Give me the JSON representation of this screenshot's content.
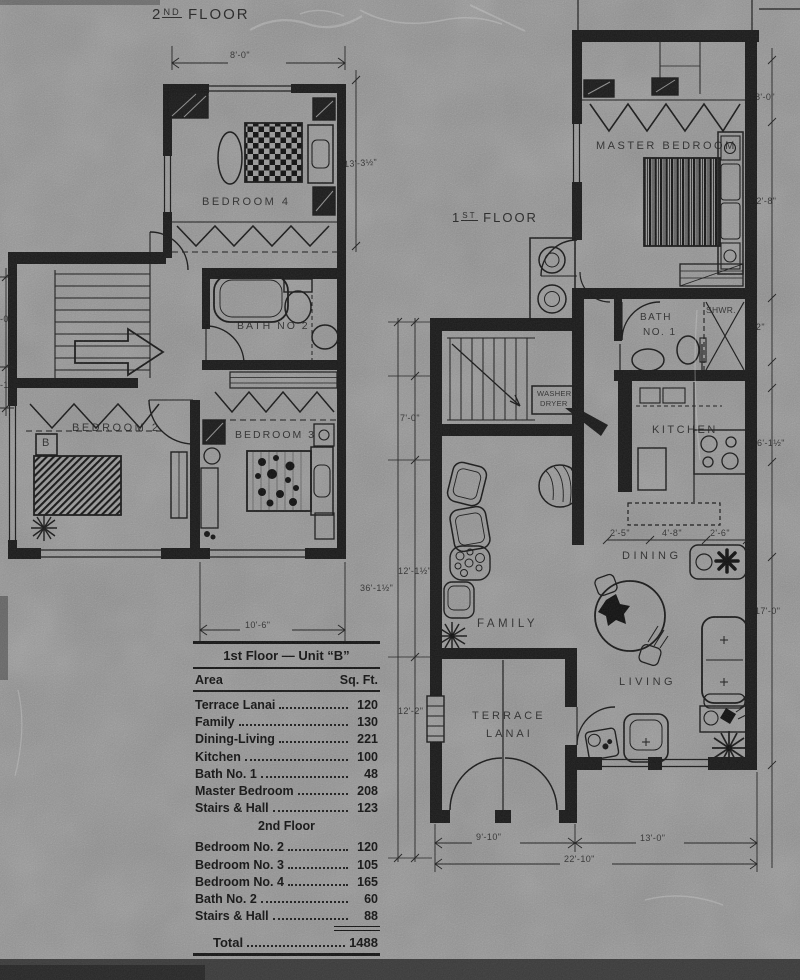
{
  "plan2": {
    "title_num": "2",
    "title_sup": "ND",
    "title_word": "FLOOR",
    "rooms": {
      "bedroom4": "BEDROOM 4",
      "bath2": "BATH NO 2",
      "bedroom2": "BEDROOM 2",
      "bedroom3": "BEDROOM 3"
    },
    "bed_tag": "B",
    "dims": {
      "top": "8'-0\"",
      "right": "13'-3½\"",
      "bottom": "10'-6\"",
      "left_a": "-0\"",
      "left_b": "-10"
    }
  },
  "plan1": {
    "title_num": "1",
    "title_sup": "ST",
    "title_word": "FLOOR",
    "rooms": {
      "master": "MASTER BEDROOM",
      "bath_l1": "BATH",
      "bath_l2": "NO. 1",
      "shwr": "SHWR.",
      "kitchen": "KITCHEN",
      "wd_l1": "WASHER",
      "wd_l2": "DRYER",
      "dining": "DINING",
      "family": "FAMILY",
      "living": "LIVING",
      "terrace_l1": "TERRACE",
      "terrace_l2": "LANAI"
    },
    "dims": {
      "right_a": "8'-0\"",
      "right_b": "12'-8\"",
      "right_c": "5'-2\"",
      "right_d": "6'-1½\"",
      "right_e": "17'-0\"",
      "left_a": "7'-0\"",
      "left_b": "12'-1½\"",
      "left_overall": "36'-1½\"",
      "left_c": "12'-2\"",
      "kit_a": "2'-5\"",
      "kit_b": "4'-8\"",
      "kit_c": "2'-6\"",
      "bot_a": "9'-10\"",
      "bot_b": "13'-0\"",
      "bot_total": "22'-10\""
    }
  },
  "table": {
    "title": "1st Floor — Unit “B”",
    "col_area": "Area",
    "col_sqft": "Sq. Ft.",
    "rows1": [
      {
        "label": "Terrace Lanai",
        "value": "120"
      },
      {
        "label": "Family",
        "value": "130"
      },
      {
        "label": "Dining-Living",
        "value": "221"
      },
      {
        "label": "Kitchen",
        "value": "100"
      },
      {
        "label": "Bath No. 1",
        "value": "48"
      },
      {
        "label": "Master Bedroom",
        "value": "208"
      },
      {
        "label": "Stairs & Hall",
        "value": "123"
      }
    ],
    "heading2": "2nd Floor",
    "rows2": [
      {
        "label": "Bedroom No. 2",
        "value": "120"
      },
      {
        "label": "Bedroom No. 3",
        "value": "105"
      },
      {
        "label": "Bedroom No. 4",
        "value": "165"
      },
      {
        "label": "Bath No. 2",
        "value": "60"
      },
      {
        "label": "Stairs & Hall",
        "value": "88"
      }
    ],
    "total_label": "Total",
    "total_value": "1488"
  }
}
